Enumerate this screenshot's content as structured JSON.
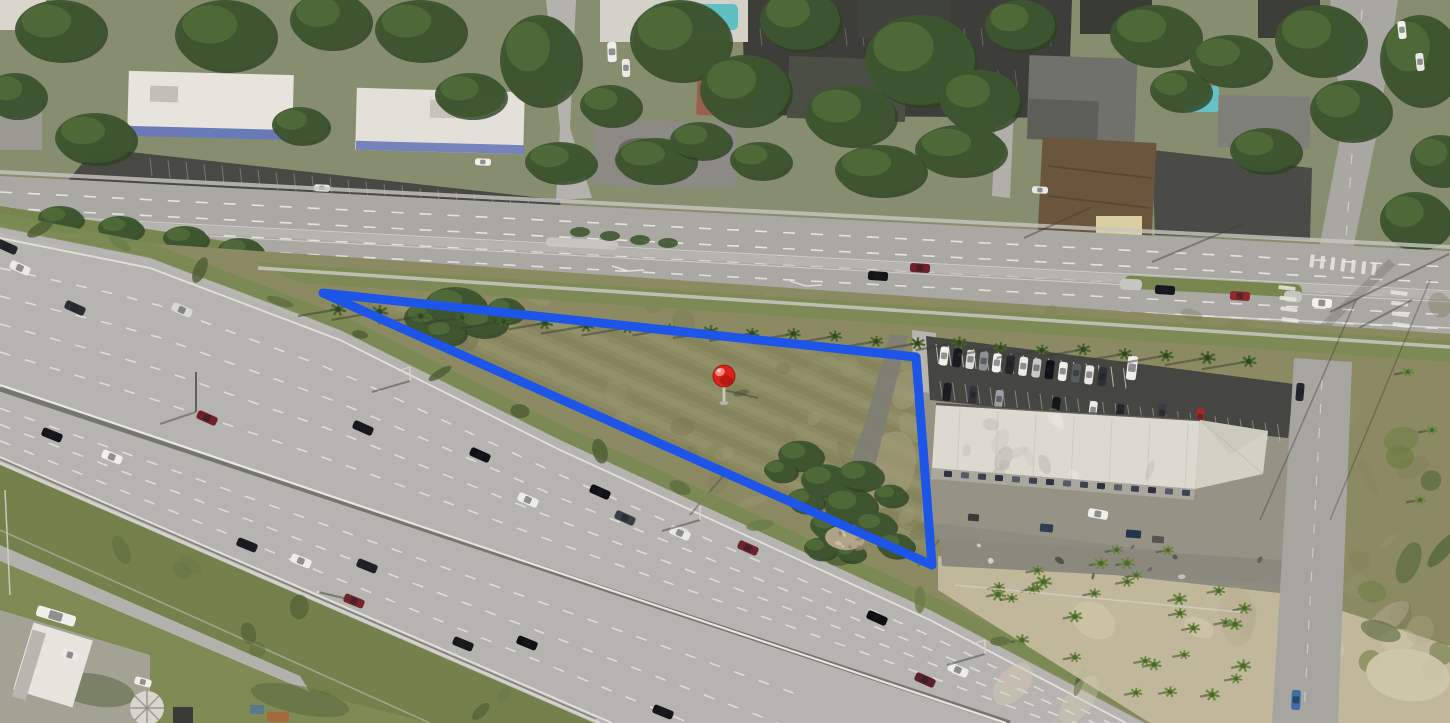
{
  "window": {
    "width_px": 1450,
    "height_px": 723,
    "view": "oblique-aerial-photo-with-parcel-overlay"
  },
  "overlay": {
    "parcel_polygon": {
      "points": "323,293 916,357 932,565",
      "stroke_color": "#1d55e8",
      "stroke_width": 9,
      "fill": "none"
    },
    "marker": {
      "cx": 724,
      "cy": 376,
      "r": 11,
      "ball_color": "#d92318",
      "ball_highlight": "#ff9c8f",
      "ball_rim": "#8f0f08",
      "pole_color": "#c9c8c2",
      "base_color": "#b6b5ae"
    }
  },
  "palette": {
    "freeway_pavement": "#b5b4b0",
    "boulevard_pavement": "#a9a8a3",
    "lane_marking": "#edefeb",
    "scrub_grass": "#8b8a62",
    "verge_grass": "#7c8955",
    "tree_canopy": "#3e5530",
    "palm_canopy": "#4c662f",
    "sand": "#c4bb9e",
    "white_roof": "#dcd9d0",
    "parking_asphalt": "#454541",
    "pool_water": "#5fc0c2",
    "brown_roof": "#6a563c"
  }
}
